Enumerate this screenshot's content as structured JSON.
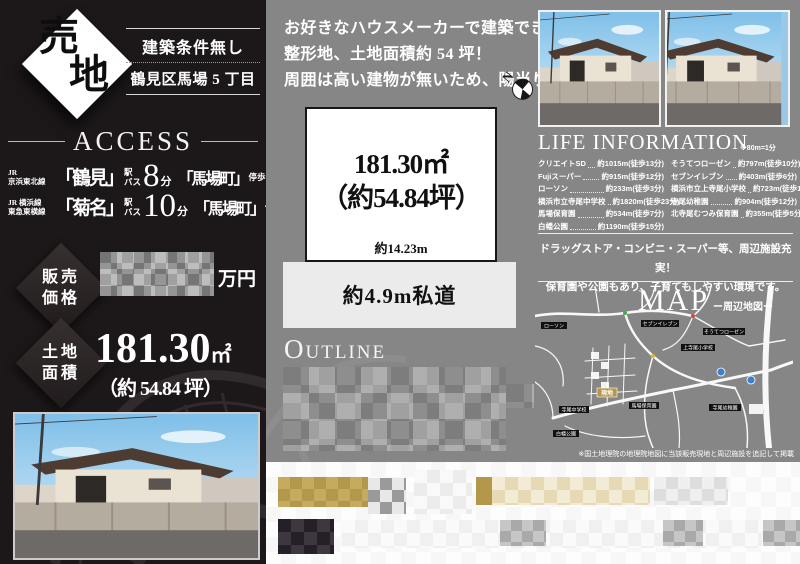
{
  "left": {
    "badge": {
      "char1": "売",
      "char2": "地"
    },
    "condition": "建築条件無し",
    "location": "鶴見区馬場 5 丁目",
    "access_title": "ACCESS",
    "access_rows": [
      {
        "line1": "JR",
        "line2": "京浜東北線",
        "station": "「鶴見」",
        "st_top": "駅",
        "st_bottom": "バス",
        "minutes": "8",
        "unit": "分",
        "stop": "「馬場町」",
        "stop_mode": "停歩",
        "stop_minutes": "3",
        "stop_unit": "分"
      },
      {
        "line1": "JR 横浜線",
        "line2": "東急東横線",
        "station": "「菊名」",
        "st_top": "駅",
        "st_bottom": "バス",
        "minutes": "10",
        "unit": "分",
        "stop": "「馬場町」",
        "stop_mode": "停歩",
        "stop_minutes": "3",
        "stop_unit": "分"
      }
    ],
    "price": {
      "label_line1": "販売",
      "label_line2": "価格",
      "unit": "万円"
    },
    "area": {
      "label_line1": "土地",
      "label_line2": "面積",
      "value": "181.30",
      "value_unit": "㎡",
      "tsubo": "（約 54.84 坪）"
    }
  },
  "center": {
    "intro_lines": [
      "お好きなハウスメーカーで建築できます。",
      "整形地、土地面積約 54 坪！",
      "周囲は高い建物が無いため、陽当り良好。"
    ],
    "compass_letter": "N",
    "plot": {
      "area_value": "181.30㎡",
      "tsubo": "（約54.84坪）",
      "frontage": "約14.23m",
      "road": "約4.9m私道"
    },
    "outline_first": "O",
    "outline_rest": "UTLINE"
  },
  "right": {
    "life": {
      "title": "LIFE INFORMATION",
      "note": "※80m=1分",
      "col1": [
        {
          "name": "クリエイトSD",
          "dist": "約1015m(徒歩13分)"
        },
        {
          "name": "Fujiスーパー",
          "dist": "約915m(徒歩12分)"
        },
        {
          "name": "ローソン",
          "dist": "約233m(徒歩3分)"
        },
        {
          "name": "横浜市立寺尾中学校",
          "dist": "約1820m(徒歩23分)"
        },
        {
          "name": "馬場保育園",
          "dist": "約534m(徒歩7分)"
        },
        {
          "name": "白幡公園",
          "dist": "約1190m(徒歩15分)"
        }
      ],
      "col2": [
        {
          "name": "そうてつローゼン",
          "dist": "約797m(徒歩10分)"
        },
        {
          "name": "セブンイレブン",
          "dist": "約403m(徒歩6分)"
        },
        {
          "name": "横浜市立上寺尾小学校",
          "dist": "約723m(徒歩10分)"
        },
        {
          "name": "寺尾幼稚園",
          "dist": "約904m(徒歩12分)"
        },
        {
          "name": "北寺尾むつみ保育園",
          "dist": "約355m(徒歩5分)"
        }
      ]
    },
    "promo_lines": [
      "ドラッグストア・コンビニ・スーパー等、周辺施設充実！",
      "保育園や公園もあり、子育てもしやすい環境です。"
    ],
    "map": {
      "title": "MAP",
      "subtitle": "ー周辺地図ー",
      "site": "現地",
      "labels": [
        "ローソン",
        "セブンイレブン",
        "上寺尾小学校",
        "そうてつローゼン",
        "寺尾中学校",
        "馬場保育園",
        "白幡公園",
        "寺尾幼稚園"
      ],
      "disclaimer": "※国土地理院の地理院地図に当該販売現地と周辺施設を追記して掲載"
    }
  },
  "colors": {
    "accent_gold": "#b3984c",
    "panel_dark": "#1c1719",
    "panel_gray": "#868686"
  }
}
